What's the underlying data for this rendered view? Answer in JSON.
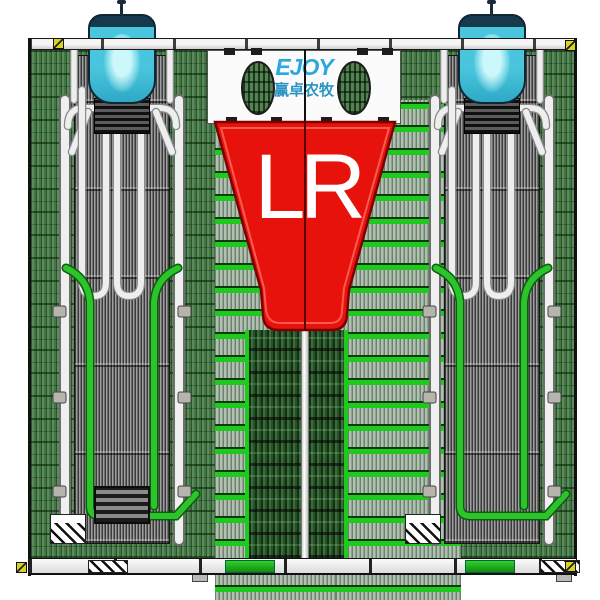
{
  "branding": {
    "logo_text": "EJOY",
    "company_name_cn": "赢卓农牧"
  },
  "funnel": {
    "left_label": "L",
    "right_label": "R"
  },
  "icons": {
    "corner_marker": "registration-marker-icon",
    "hopper": "feed-hopper",
    "funnel": "sorting-funnel"
  },
  "colors": {
    "funnel_red": "#e8120c",
    "funnel_edge_dark": "#7c0000",
    "letter_white": "#ffffff",
    "beam_green": "#1fca1f",
    "floor_green": "#4e7d4e",
    "floor_dark_green": "#17311a",
    "green_pipe": "#26b826",
    "crate_gray": "#9a9a9a",
    "pipe_white": "#eeeeee",
    "hopper_cyan": "#49c6dd",
    "hopper_rim_navy": "#16394e",
    "logo_blue": "#2aa8e0",
    "company_teal": "#2a93c4",
    "marker_yellow": "#d6d41c",
    "panel_white": "#fbfbfb",
    "background_white": "#ffffff"
  }
}
